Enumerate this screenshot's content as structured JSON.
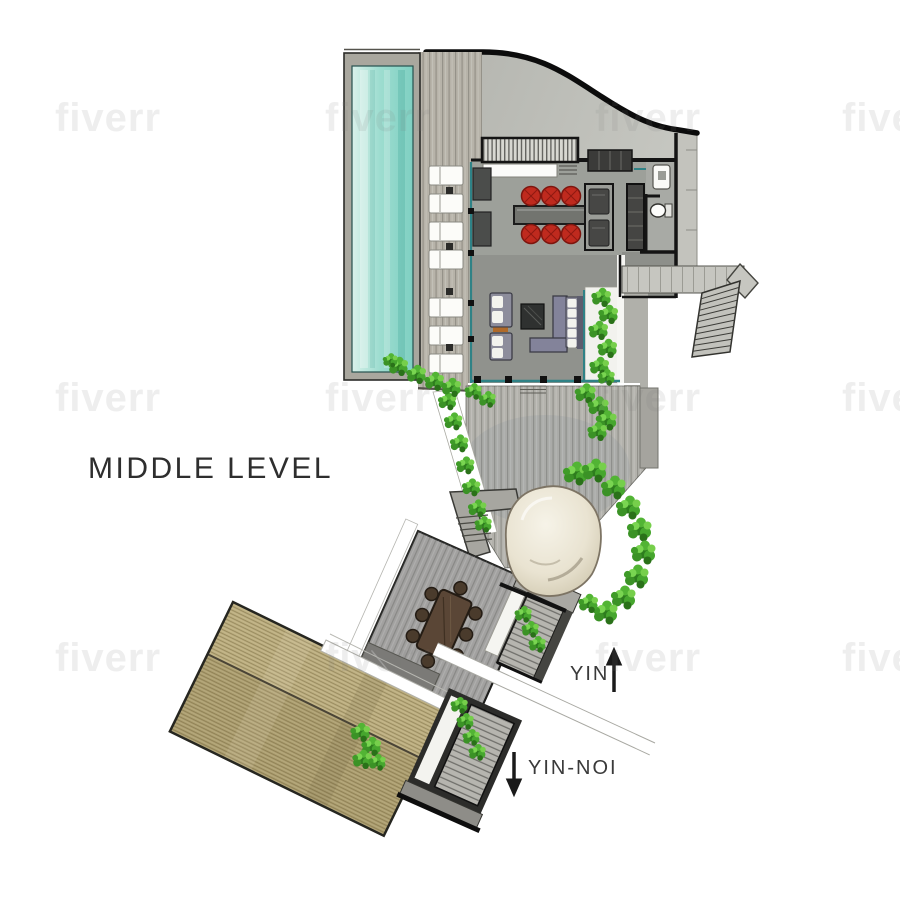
{
  "title": "MIDDLE LEVEL",
  "directions": {
    "up_label": "YIN",
    "down_label": "YIN-NOI"
  },
  "watermark_text": "fiverr",
  "palette": {
    "pool_water": "#8fd6c9",
    "pool_coping": "#a9a79e",
    "deck_wood": "#b5b2a8",
    "roof_concrete": "#bbbcb6",
    "interior_floor_dining": "#9da09a",
    "interior_floor_living": "#90928d",
    "accent_chair_red": "#bf2a1e",
    "foliage_green": "#3f9b2f",
    "timber_roof": "#b3a477",
    "stone_boulder": "#e9e3d1",
    "glass_teal": "#2f8286",
    "wall_black": "#141414"
  }
}
